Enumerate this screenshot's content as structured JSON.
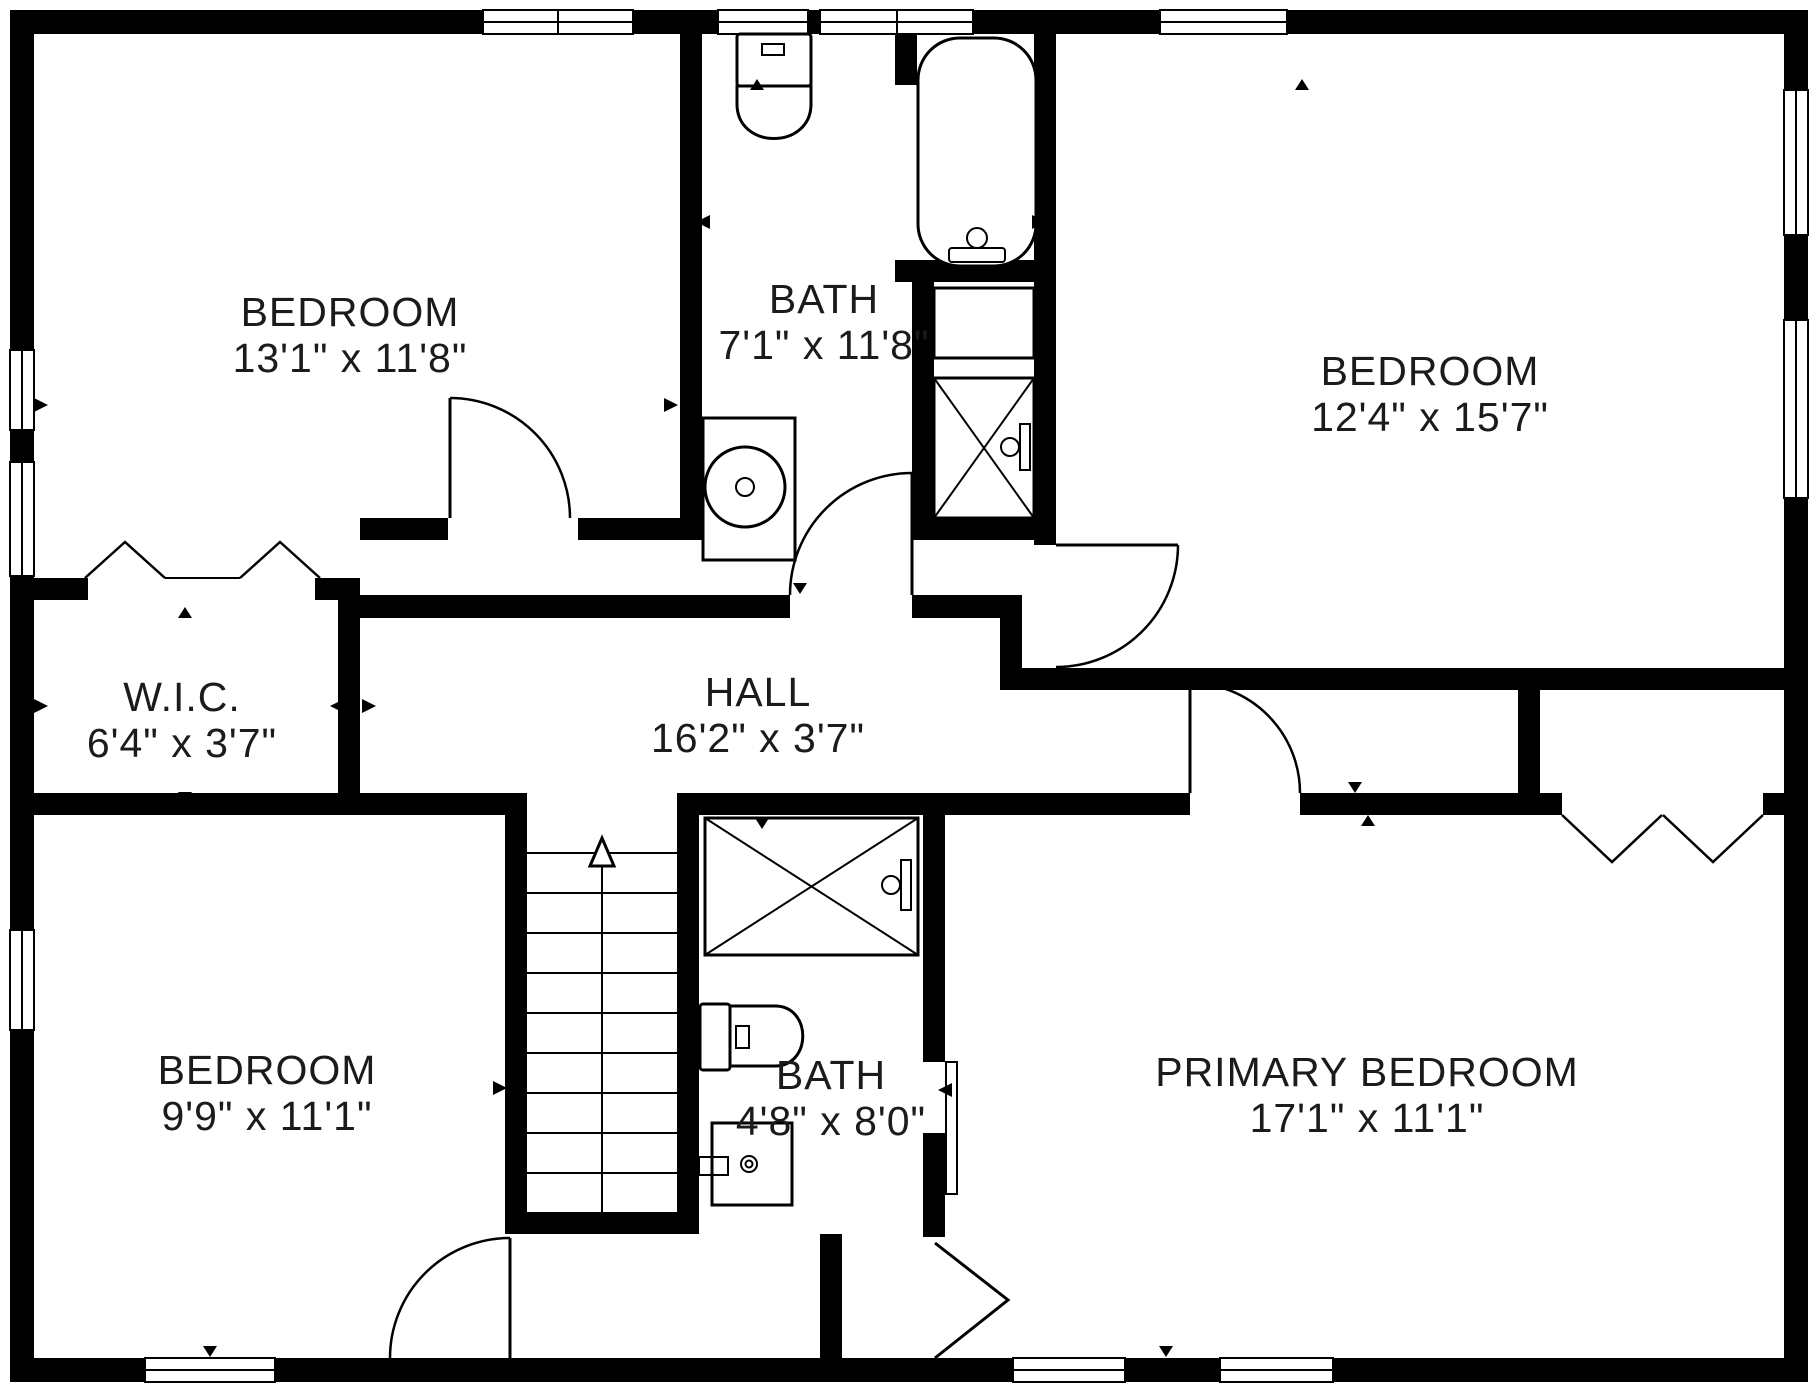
{
  "plan": {
    "title": "Second floor plan",
    "rooms": [
      {
        "id": "bedroom-top-left",
        "name": "BEDROOM",
        "dims": "13'1\" x 11'8\""
      },
      {
        "id": "bath-top",
        "name": "BATH",
        "dims": "7'1\" x 11'8\""
      },
      {
        "id": "bedroom-top-right",
        "name": "BEDROOM",
        "dims": "12'4\" x 15'7\""
      },
      {
        "id": "walk-in-closet",
        "name": "W.I.C.",
        "dims": "6'4\" x 3'7\""
      },
      {
        "id": "hall",
        "name": "HALL",
        "dims": "16'2\" x 3'7\""
      },
      {
        "id": "bedroom-bottom-left",
        "name": "BEDROOM",
        "dims": "9'9\" x 11'1\""
      },
      {
        "id": "bath-bottom",
        "name": "BATH",
        "dims": "4'8\" x 8'0\""
      },
      {
        "id": "primary-bedroom",
        "name": "PRIMARY BEDROOM",
        "dims": "17'1\" x 11'1\""
      }
    ],
    "colors": {
      "wall": "#000000",
      "background": "#ffffff",
      "text": "#1b1b1b"
    }
  }
}
